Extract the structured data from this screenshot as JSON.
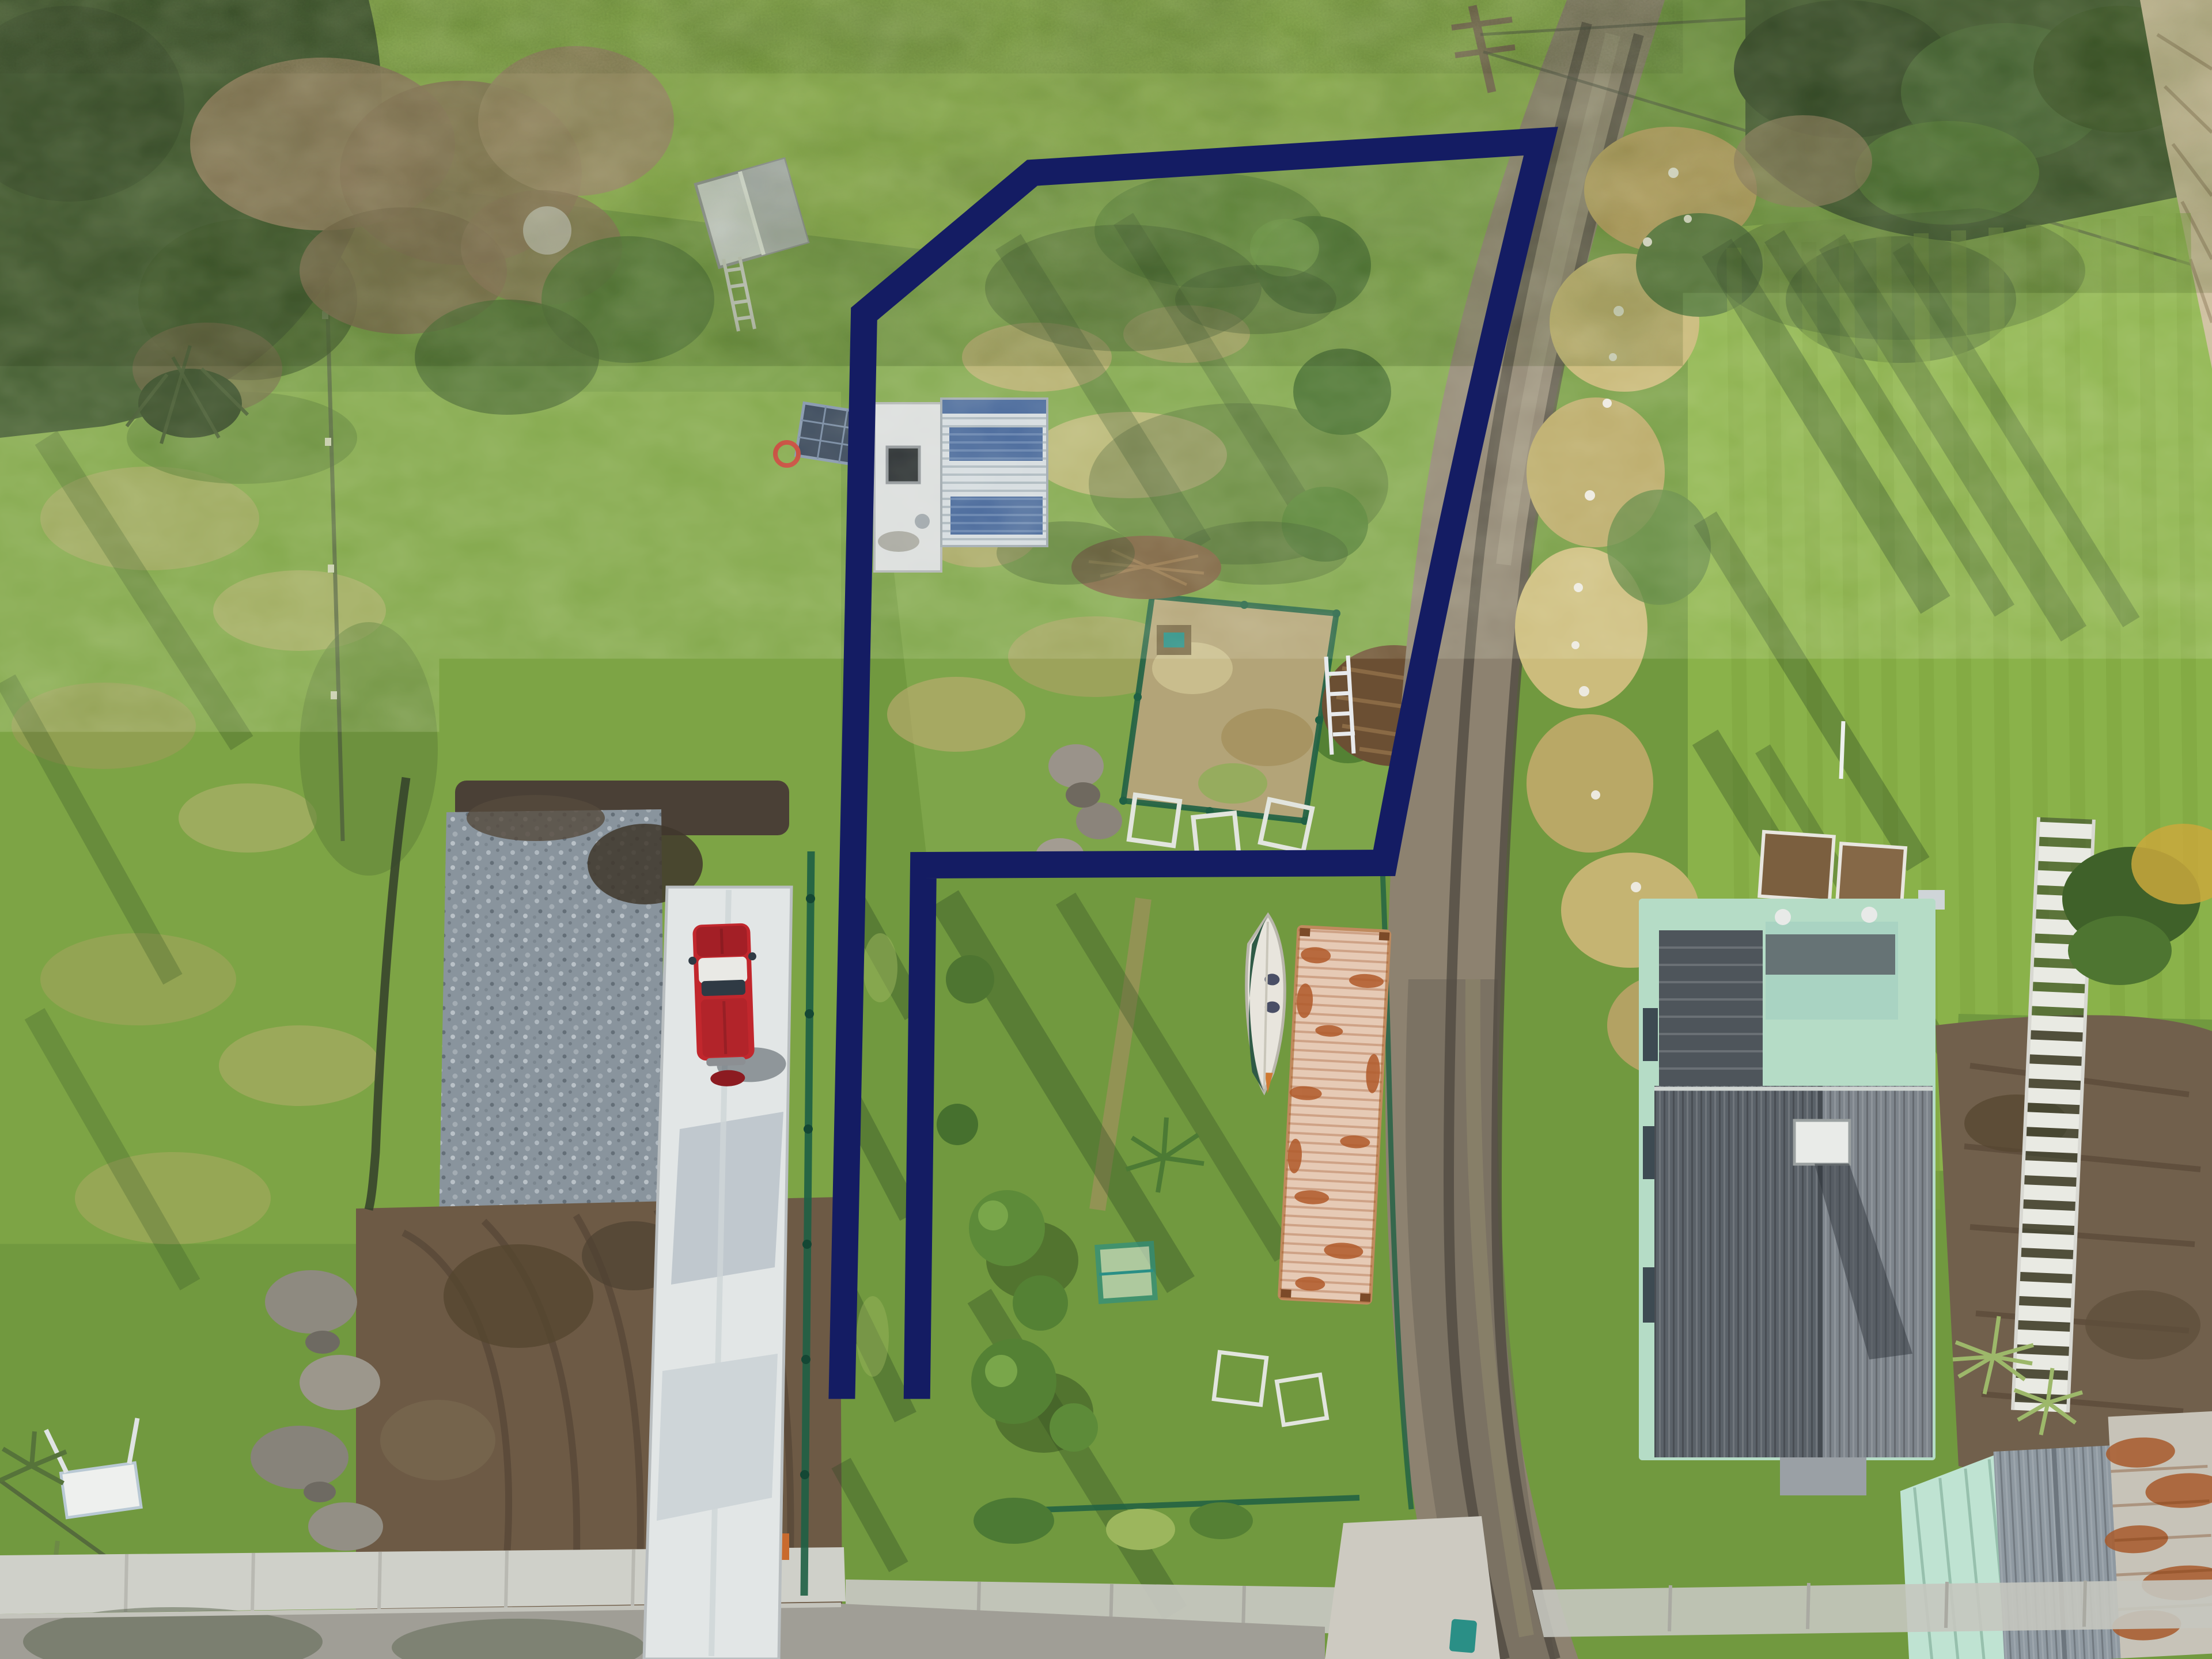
{
  "image": {
    "kind": "aerial-drone-photograph",
    "subject": "residential section with marked property boundary",
    "caption": "BOUNDARY LINES ARE INDICATIVE ONLY"
  },
  "overlay": {
    "boundary_shape": "flag-shaped lot: large upper paddock plus narrow access strip running to street",
    "line_style": "thick solid navy outline"
  },
  "colors": {
    "boundary_navy": "#141c63",
    "caption_navy": "#1c2673",
    "grass_base": "#71993f",
    "grass_bright": "#8fb44c",
    "grass_pale": "#a9bf62",
    "grass_dark": "#44632e",
    "shadow_green": "#2e4a23",
    "tussock_tan": "#bfae72",
    "scrub_brown": "#927d5e",
    "hedge_dark": "#3a5529",
    "road_gravel": "#8d8270",
    "road_dark": "#6e665a",
    "concrete": "#e2e6e6",
    "footpath": "#cfd0c9",
    "asphalt": "#a09e96",
    "gravel_pad": "#97a2aa",
    "mud_brown": "#6d5a45",
    "truck_red": "#c1272d",
    "truck_roof": "#e9e9e5",
    "shed_silver": "#d3dade",
    "shed_blue": "#3e6097",
    "flat_roof": "#d9dcdb",
    "house_roof_dark": "#5b6269",
    "house_roof_light": "#7e858c",
    "house_mint": "#b5dcc6",
    "rust": "#a85a2c",
    "container_pale": "#e6cab5",
    "boat_hull": "#e8e5dd",
    "tarp_green": "#2f5a46",
    "fence_green": "#1f6044",
    "bin_teal": "#2a8f86"
  },
  "features": [
    {
      "name": "boundary-overlay",
      "label": "navy property boundary outline"
    },
    {
      "name": "main-shed",
      "label": "shed with white and blue striped corrugated roof"
    },
    {
      "name": "small-shed",
      "label": "small gabled garden shed"
    },
    {
      "name": "solar-panel",
      "label": "ground-mounted solar panel"
    },
    {
      "name": "veggie-garden",
      "label": "mesh-fenced vegetable garden"
    },
    {
      "name": "red-truck",
      "label": "red pickup truck on concrete driveway"
    },
    {
      "name": "concrete-driveway",
      "label": "white concrete driveway"
    },
    {
      "name": "gravel-pad",
      "label": "crushed rock hardfill pad"
    },
    {
      "name": "mud-area",
      "label": "churned earthworks with tyre tracks"
    },
    {
      "name": "gravel-road",
      "label": "gravel lane with wheel ruts"
    },
    {
      "name": "shipping-container",
      "label": "rusty shipping container"
    },
    {
      "name": "boat",
      "label": "small boat with green tarp"
    },
    {
      "name": "neighbor-house",
      "label": "mint weatherboard house with grey corrugated roof"
    },
    {
      "name": "outbuilding",
      "label": "corrugated outbuilding with rusted roof"
    },
    {
      "name": "white-slat-fence",
      "label": "white slatted fence"
    },
    {
      "name": "wheelie-bin",
      "label": "teal wheelie bin"
    },
    {
      "name": "footpath",
      "label": "concrete footpath and vehicle crossing"
    },
    {
      "name": "caption",
      "label": "disclaimer text"
    }
  ]
}
